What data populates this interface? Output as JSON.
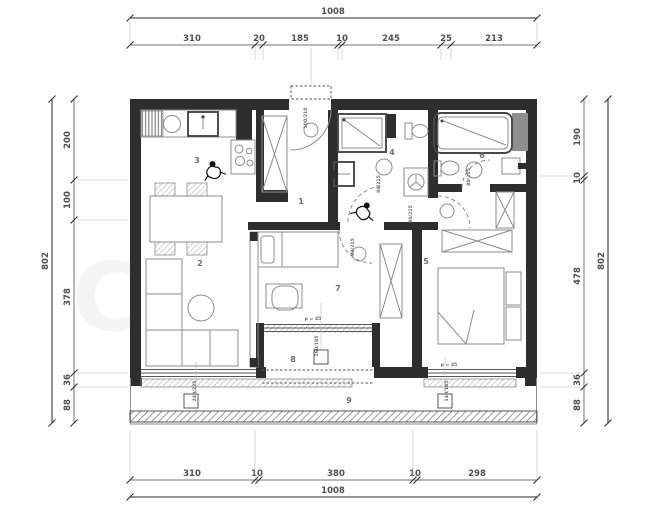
{
  "dimensions": {
    "top": {
      "total": "1008",
      "segments": [
        "310",
        "20",
        "185",
        "10",
        "245",
        "25",
        "213"
      ]
    },
    "bottom": {
      "total": "1008",
      "segments": [
        "310",
        "10",
        "380",
        "10",
        "298"
      ]
    },
    "left": {
      "total": "802",
      "segments": [
        "200",
        "100",
        "378",
        "36",
        "88"
      ]
    },
    "right": {
      "total": "802",
      "segments": [
        "190",
        "10",
        "478",
        "36",
        "88"
      ]
    }
  },
  "rooms": {
    "hall": "1",
    "living": "2",
    "kitchen": "3",
    "bathroom": "4",
    "bedroom_main": "5",
    "toilet": "6",
    "bedroom_small": "7",
    "loggia": "8",
    "terrace": "9"
  },
  "openings": {
    "entry_door": "100/210",
    "bathroom_door": "80/215",
    "toilet_door": "80/215",
    "bedroom_main_door": "80/215",
    "bedroom_small_door": "80/215",
    "parapet_balcony": "p = 45",
    "parapet_bedroom": "p = 45",
    "window_living": "240/235",
    "window_balcony": "160/185",
    "window_bedroom": "140/185"
  },
  "watermark": "C",
  "colors": {
    "wall": "#2e2e2e",
    "furniture_line": "#8c8c8c",
    "dimension_text": "#4a4a4a",
    "background": "#ffffff"
  }
}
